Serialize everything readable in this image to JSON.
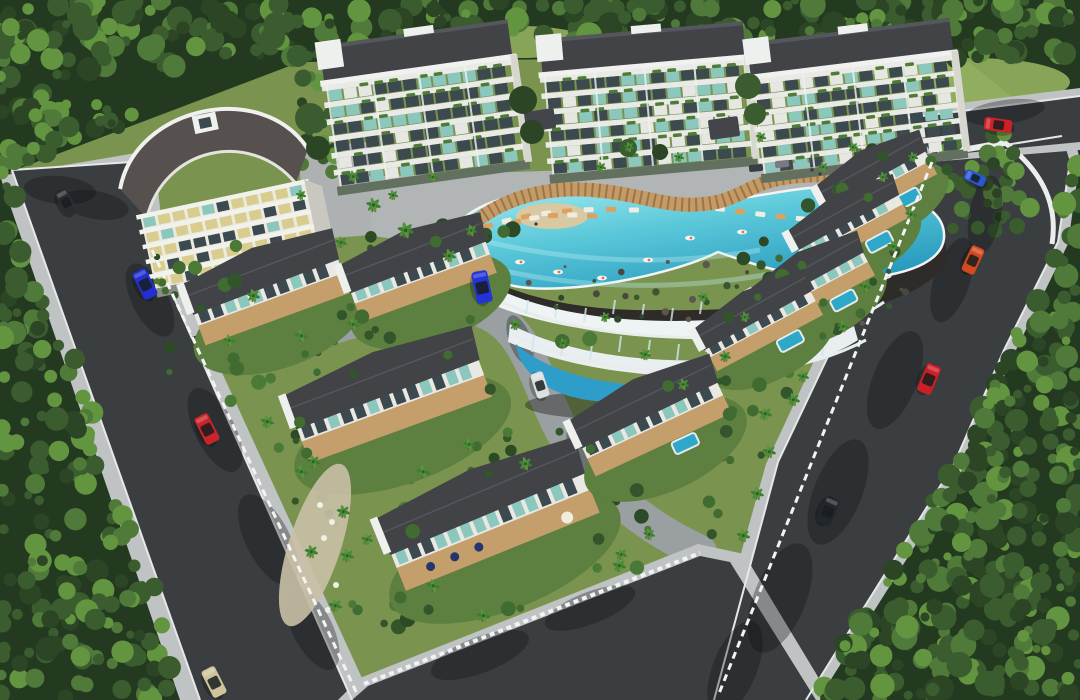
{
  "scene": {
    "description": "Aerial 3D architectural rendering of a gated residential complex: three apartment blocks, a curved-roof tower, duplex and hillside villas, a freeform infinity pool with a multi-level waterfall feature, looping asphalt roads with cars, surrounded by dense forest",
    "palette": {
      "forest_base": "#233920",
      "foliage_dark": "#2b4525",
      "foliage_mid": "#3a5c2e",
      "foliage_light": "#4f7a3a",
      "foliage_bright": "#639440",
      "grass": "#7a9450",
      "lawn": "#93b05f",
      "asphalt": "#3b3e41",
      "sidewalk": "#c0c3c4",
      "curb": "#e6e8e8",
      "internal_road": "#9aa0a2",
      "plaza": "#b2b5b6",
      "roof_dark": "#414347",
      "roof_ridge": "#54575c",
      "tower_roof": "#56504e",
      "facade": "#eceade",
      "facade_shadow": "#c9c8c0",
      "slab": "#e9eae5",
      "glass_dark": "#3c4a50",
      "glass_teal": "#8cc7bd",
      "glass_warm": "#d8cd8f",
      "plant": "#4e7c36",
      "pool_light": "#a9ecef",
      "pool_deep": "#2ea8c9",
      "pool_lower": "#2f9dc9",
      "rock": "#2e2b28",
      "waterfall": "#eef3f4",
      "wood": "#c49e6b",
      "pergola": "#c59a64",
      "pergola_slat": "#8a6a42",
      "fence": "#f2f3f2",
      "sand": "#d9c9a3"
    },
    "apartment_blocks": [
      {
        "name": "apartment-block-left",
        "x": 330,
        "y": 32,
        "w": 186,
        "h": 142,
        "rot": -8,
        "floors": 6
      },
      {
        "name": "apartment-block-middle",
        "x": 547,
        "y": 30,
        "w": 200,
        "h": 136,
        "rot": -5,
        "floors": 6
      },
      {
        "name": "apartment-block-right",
        "x": 756,
        "y": 30,
        "w": 200,
        "h": 132,
        "rot": -7,
        "floors": 6
      }
    ],
    "tower": {
      "name": "curved-roof-tower",
      "floors": 5
    },
    "villas": [
      {
        "name": "villa-duplex-1",
        "cx": 268,
        "cy": 292,
        "w": 150,
        "h": 80,
        "rot": -20
      },
      {
        "name": "villa-duplex-2",
        "cx": 420,
        "cy": 272,
        "w": 140,
        "h": 75,
        "rot": -20
      },
      {
        "name": "villa-duplex-3",
        "cx": 390,
        "cy": 400,
        "w": 190,
        "h": 88,
        "rot": -20
      },
      {
        "name": "villa-duplex-4",
        "cx": 490,
        "cy": 520,
        "w": 205,
        "h": 95,
        "rot": -22,
        "deck": true
      },
      {
        "name": "villa-hillside-1",
        "cx": 878,
        "cy": 182,
        "w": 108,
        "h": 58,
        "rot": -28,
        "pool": true
      },
      {
        "name": "villa-hillside-2",
        "cx": 850,
        "cy": 226,
        "w": 110,
        "h": 56,
        "rot": -28,
        "pool": true
      },
      {
        "name": "villa-hillside-3",
        "cx": 814,
        "cy": 284,
        "w": 112,
        "h": 58,
        "rot": -28,
        "pool": true
      },
      {
        "name": "villa-hillside-4",
        "cx": 760,
        "cy": 324,
        "w": 116,
        "h": 60,
        "rot": -28,
        "pool": true
      },
      {
        "name": "villa-hillside-5",
        "cx": 652,
        "cy": 420,
        "w": 146,
        "h": 76,
        "rot": -25,
        "pool": true
      }
    ],
    "cars": [
      {
        "name": "parked-dark-car",
        "x": 66,
        "y": 202,
        "rot": 62,
        "color": "#2b2d31",
        "len": 26,
        "wid": 13
      },
      {
        "name": "blue-car-left-road",
        "x": 145,
        "y": 284,
        "rot": 63,
        "color": "#2230d2",
        "len": 30,
        "wid": 15
      },
      {
        "name": "red-car-left-road",
        "x": 207,
        "y": 429,
        "rot": 63,
        "color": "#c8242a",
        "len": 30,
        "wid": 15
      },
      {
        "name": "beige-car-left-road",
        "x": 214,
        "y": 682,
        "rot": 63,
        "color": "#cfc49e",
        "len": 30,
        "wid": 15
      },
      {
        "name": "blue-van-internal",
        "x": 482,
        "y": 287,
        "rot": 78,
        "color": "#2334d6",
        "len": 32,
        "wid": 16
      },
      {
        "name": "white-car-internal",
        "x": 540,
        "y": 385,
        "rot": 72,
        "color": "#dddfe0",
        "len": 26,
        "wid": 13
      },
      {
        "name": "red-car-top-right",
        "x": 998,
        "y": 125,
        "rot": 8,
        "color": "#cc2127",
        "len": 28,
        "wid": 13
      },
      {
        "name": "blue-car-junction",
        "x": 975,
        "y": 178,
        "rot": 25,
        "color": "#2a55d0",
        "len": 22,
        "wid": 11
      },
      {
        "name": "orange-car-right-road",
        "x": 973,
        "y": 260,
        "rot": 115,
        "color": "#d2491f",
        "len": 28,
        "wid": 14
      },
      {
        "name": "red-convertible-right-road",
        "x": 929,
        "y": 379,
        "rot": 113,
        "color": "#cb1f26",
        "len": 30,
        "wid": 15
      },
      {
        "name": "dark-buggy-right-road",
        "x": 828,
        "y": 511,
        "rot": 113,
        "color": "#23262a",
        "len": 28,
        "wid": 15
      }
    ],
    "pool": {
      "name": "infinity-pool",
      "type": "freeform",
      "feature": "two-tier-waterfall-cliff",
      "floats": 8,
      "lounger_rows": 2
    },
    "palms": [
      [
        372,
        212,
        1
      ],
      [
        404,
        238,
        1.1
      ],
      [
        448,
        262,
        0.9
      ],
      [
        340,
        248,
        0.8
      ],
      [
        252,
        302,
        0.9
      ],
      [
        228,
        346,
        0.8
      ],
      [
        300,
        342,
        0.9
      ],
      [
        352,
        330,
        0.8
      ],
      [
        266,
        428,
        0.9
      ],
      [
        312,
        468,
        0.9
      ],
      [
        342,
        518,
        0.9
      ],
      [
        310,
        558,
        0.9
      ],
      [
        366,
        545,
        0.8
      ],
      [
        422,
        478,
        0.9
      ],
      [
        468,
        450,
        0.8
      ],
      [
        524,
        470,
        0.9
      ],
      [
        618,
        572,
        0.9
      ],
      [
        648,
        540,
        0.8
      ],
      [
        620,
        560,
        0.8
      ],
      [
        432,
        592,
        0.9
      ],
      [
        482,
        622,
        0.9
      ],
      [
        486,
        302,
        0.8
      ],
      [
        514,
        330,
        0.8
      ],
      [
        562,
        348,
        0.7
      ],
      [
        604,
        322,
        0.7
      ],
      [
        644,
        360,
        0.8
      ],
      [
        682,
        390,
        0.8
      ],
      [
        724,
        362,
        0.8
      ],
      [
        744,
        322,
        0.7
      ],
      [
        702,
        302,
        0.7
      ],
      [
        764,
        420,
        0.9
      ],
      [
        802,
        382,
        0.8
      ],
      [
        842,
        332,
        0.8
      ],
      [
        864,
        292,
        0.8
      ],
      [
        892,
        252,
        0.8
      ],
      [
        910,
        220,
        0.8
      ],
      [
        792,
        406,
        0.9
      ],
      [
        768,
        458,
        0.9
      ],
      [
        756,
        500,
        0.9
      ],
      [
        742,
        542,
        0.9
      ],
      [
        352,
        182,
        0.8
      ],
      [
        392,
        200,
        0.7
      ],
      [
        432,
        182,
        0.7
      ],
      [
        300,
        200,
        0.7
      ],
      [
        628,
        152,
        0.7
      ],
      [
        600,
        172,
        0.7
      ],
      [
        678,
        162,
        0.7
      ],
      [
        822,
        172,
        0.7
      ],
      [
        852,
        152,
        0.7
      ],
      [
        882,
        182,
        0.7
      ],
      [
        912,
        162,
        0.7
      ],
      [
        760,
        142,
        0.7
      ],
      [
        470,
        236,
        0.8
      ],
      [
        300,
        478,
        0.9
      ],
      [
        346,
        562,
        0.9
      ],
      [
        334,
        612,
        0.9
      ]
    ]
  }
}
